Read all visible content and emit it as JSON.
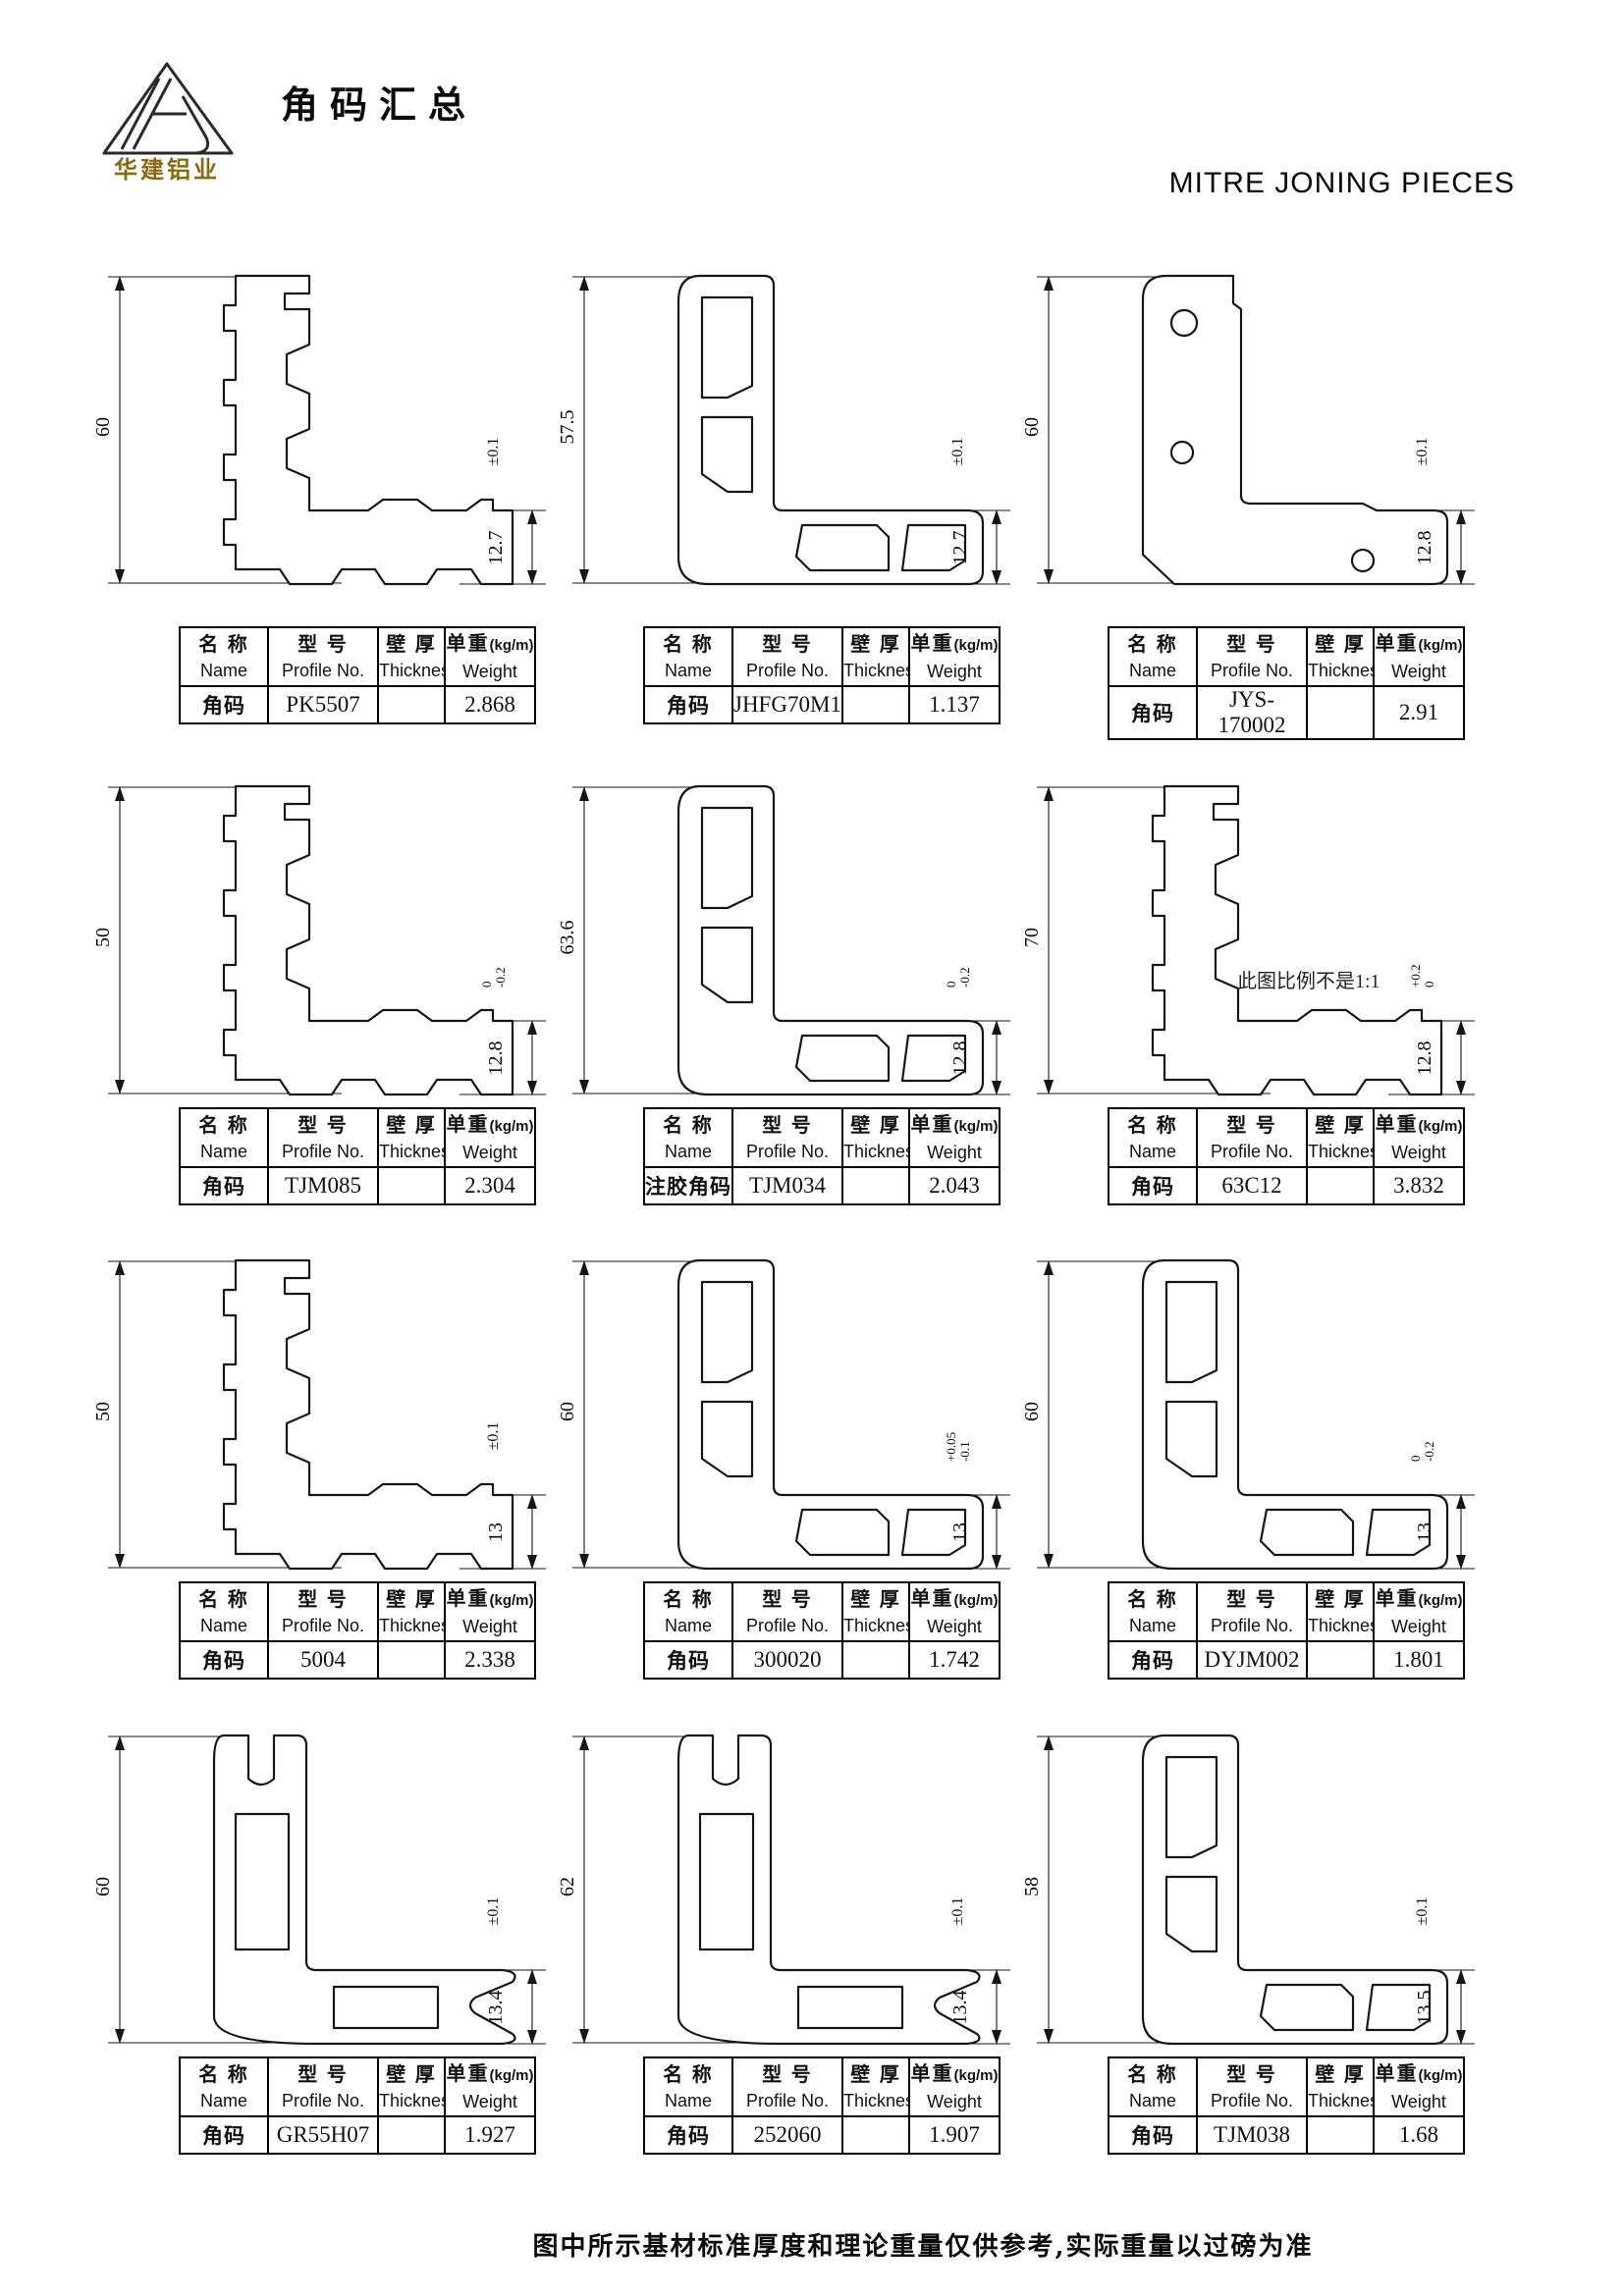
{
  "page": {
    "title": "角码汇总",
    "subtitle": "MITRE JONING PIECES",
    "logo_text": "华建铝业",
    "footer": "图中所示基材标准厚度和理论重量仅供参考,实际重量以过磅为准",
    "accent_gold": "#8a6a15",
    "rule_color": "#4a4a4a"
  },
  "table_headers": {
    "name_zh": "名 称",
    "name_en": "Name",
    "profile_zh": "型 号",
    "profile_en": "Profile No.",
    "thickness_zh": "壁 厚",
    "thickness_en": "Thickness",
    "weight_zh": "单重",
    "weight_unit": "(kg/m)",
    "weight_en": "Weight"
  },
  "cells": [
    {
      "name": "角码",
      "profile_no": "PK5507",
      "thickness": "",
      "weight": "2.868",
      "dim_height": "60",
      "dim_foot": "12.7",
      "tol": "±0.1",
      "tol_upper": "",
      "tol_lower": "",
      "note": ""
    },
    {
      "name": "角码",
      "profile_no": "JHFG70M19",
      "thickness": "",
      "weight": "1.137",
      "dim_height": "57.5",
      "dim_foot": "12.7",
      "tol": "±0.1",
      "tol_upper": "",
      "tol_lower": "",
      "note": ""
    },
    {
      "name": "角码",
      "profile_no": "JYS-170002",
      "thickness": "",
      "weight": "2.91",
      "dim_height": "60",
      "dim_foot": "12.8",
      "tol": "±0.1",
      "tol_upper": "",
      "tol_lower": "",
      "note": ""
    },
    {
      "name": "角码",
      "profile_no": "TJM085",
      "thickness": "",
      "weight": "2.304",
      "dim_height": "50",
      "dim_foot": "12.8",
      "tol": "",
      "tol_upper": "0",
      "tol_lower": "-0.2",
      "note": ""
    },
    {
      "name": "注胶角码",
      "profile_no": "TJM034",
      "thickness": "",
      "weight": "2.043",
      "dim_height": "63.6",
      "dim_foot": "12.8",
      "tol": "",
      "tol_upper": "0",
      "tol_lower": "-0.2",
      "note": ""
    },
    {
      "name": "角码",
      "profile_no": "63C12",
      "thickness": "",
      "weight": "3.832",
      "dim_height": "70",
      "dim_foot": "12.8",
      "tol": "",
      "tol_upper": "+0.2",
      "tol_lower": "0",
      "note": "此图比例不是1:1"
    },
    {
      "name": "角码",
      "profile_no": "5004",
      "thickness": "",
      "weight": "2.338",
      "dim_height": "50",
      "dim_foot": "13",
      "tol": "±0.1",
      "tol_upper": "",
      "tol_lower": "",
      "note": ""
    },
    {
      "name": "角码",
      "profile_no": "300020",
      "thickness": "",
      "weight": "1.742",
      "dim_height": "60",
      "dim_foot": "13",
      "tol": "",
      "tol_upper": "+0.05",
      "tol_lower": "-0.1",
      "note": ""
    },
    {
      "name": "角码",
      "profile_no": "DYJM002",
      "thickness": "",
      "weight": "1.801",
      "dim_height": "60",
      "dim_foot": "13",
      "tol": "",
      "tol_upper": "0",
      "tol_lower": "-0.2",
      "note": ""
    },
    {
      "name": "角码",
      "profile_no": "GR55H07",
      "thickness": "",
      "weight": "1.927",
      "dim_height": "60",
      "dim_foot": "13.4",
      "tol": "±0.1",
      "tol_upper": "",
      "tol_lower": "",
      "note": ""
    },
    {
      "name": "角码",
      "profile_no": "252060",
      "thickness": "",
      "weight": "1.907",
      "dim_height": "62",
      "dim_foot": "13.4",
      "tol": "±0.1",
      "tol_upper": "",
      "tol_lower": "",
      "note": ""
    },
    {
      "name": "角码",
      "profile_no": "TJM038",
      "thickness": "",
      "weight": "1.68",
      "dim_height": "58",
      "dim_foot": "13.5",
      "tol": "±0.1",
      "tol_upper": "",
      "tol_lower": "",
      "note": ""
    }
  ]
}
